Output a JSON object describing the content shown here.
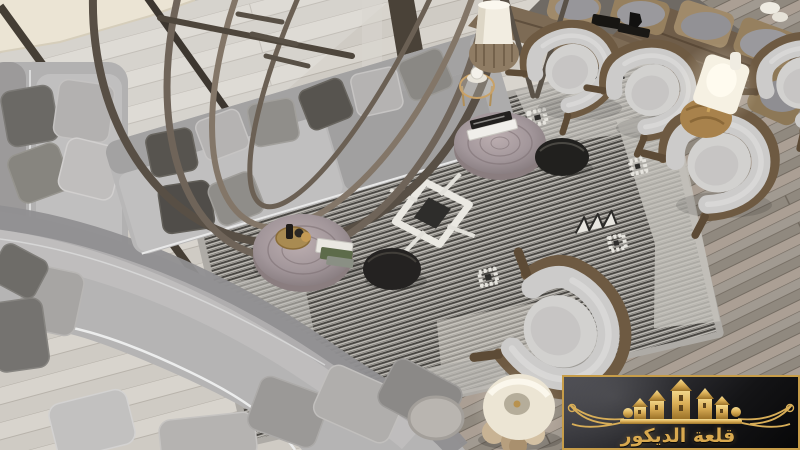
{
  "watermark": {
    "text": "قلعة الديكور",
    "border": "#c79d49",
    "gold": "#d3a755",
    "gold_light": "#f6dd92",
    "gold_dark": "#9c7329",
    "panel_dark": "#0b0b0d"
  },
  "palette": {
    "stone_terrace": "#e7dfcc",
    "floor_light_wood": "#d6d2cb",
    "floor_dark_wood": "#9b948b",
    "window_frame": "#453e35",
    "metal_sculpture": "#6b6156",
    "sofa_fabric": "#b7b6b6",
    "sofa_backrest": "#908f91",
    "pillow_charcoal": "#55524d",
    "rug_stripe_dark": "#403e3a",
    "rug_stripe_light": "#c6c3bd",
    "rug_motif_white": "#eae8e2",
    "armchair_wood": "#6e5a42",
    "armchair_cushion": "#cccbca",
    "stump_table": "#a2969a",
    "side_table_dark": "#21201e",
    "lamp_shade": "#f2ecdf",
    "lamp_base_gold": "#a8824c"
  }
}
